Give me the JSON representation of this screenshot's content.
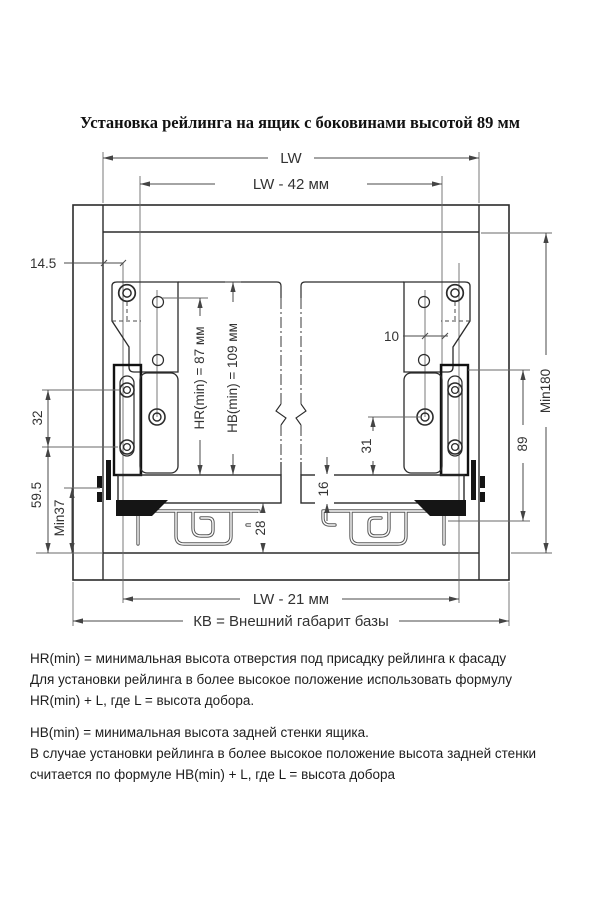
{
  "title": "Установка рейлинга на ящик с боковинами высотой 89 мм",
  "dimensions": {
    "lw": "LW",
    "lw42": "LW - 42 мм",
    "d14_5": "14.5",
    "d32": "32",
    "d59_5": "59.5",
    "min37": "Min37",
    "hr_min": "HR(min) = 87 мм",
    "hb_min": "HB(min) = 109 мм",
    "d10": "10",
    "d31": "31",
    "d16": "16",
    "d28": "28",
    "d89": "89",
    "min180": "Min180",
    "lw21": "LW - 21 мм",
    "kv": "КВ = Внешний габарит базы"
  },
  "notes": {
    "hr": [
      "HR(min) = минимальная высота отверстия под присадку рейлинга к фасаду",
      "Для установки рейлинга в более высокое положение использовать формулу",
      "HR(min) + L,  где L = высота добора."
    ],
    "hb": [
      "HB(min) = минимальная высота задней стенки ящика.",
      "В случае установки рейлинга в более высокое положение высота задней стенки",
      "считается по формуле HB(min) + L, где L = высота добора"
    ]
  },
  "colors": {
    "line": "#2b2b2b",
    "dim": "#4a4a4a",
    "dark_profile": "#151515",
    "background": "#ffffff"
  }
}
